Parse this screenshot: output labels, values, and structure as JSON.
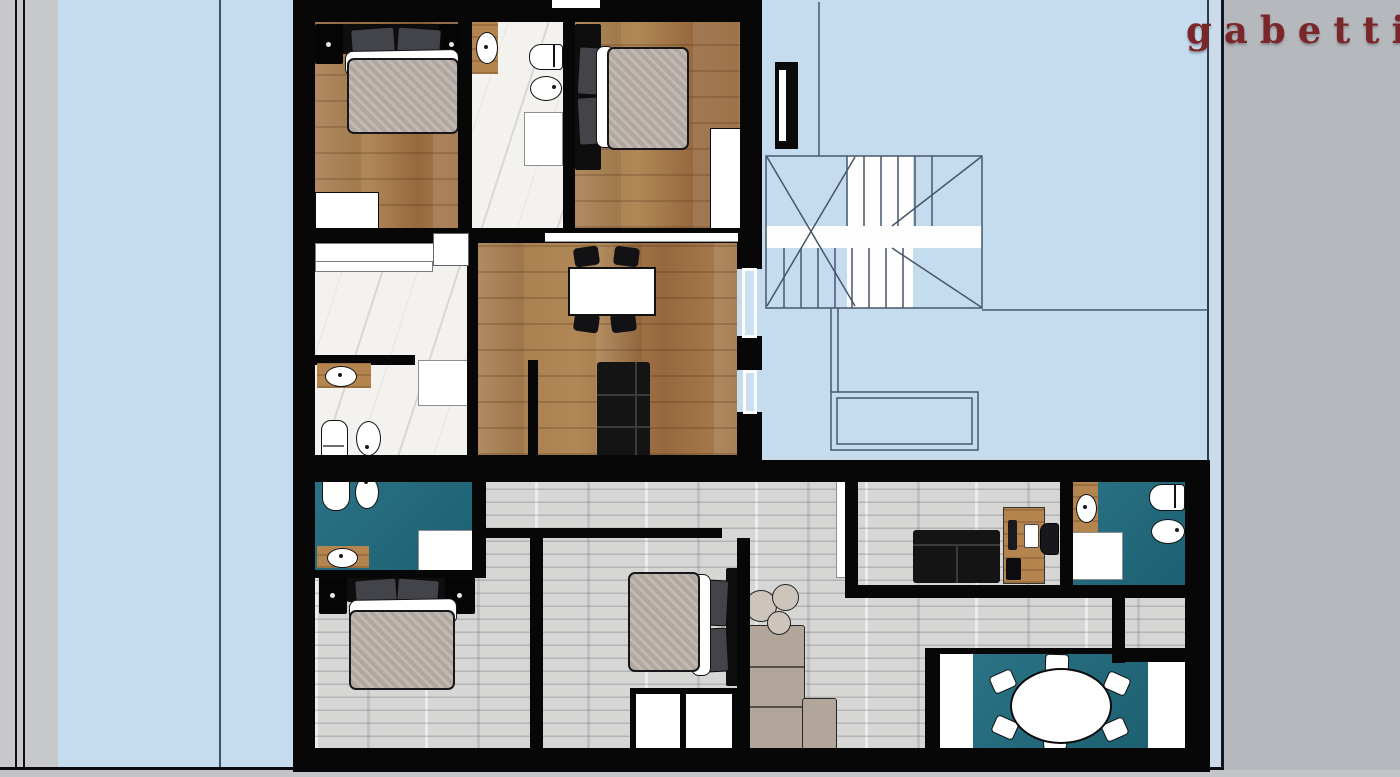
{
  "brand": {
    "name": "gabetti",
    "color": "#7b2628"
  },
  "palette": {
    "sky": "#c4dcee",
    "strip": "#ccdbe9",
    "paper": "#b5b8bc",
    "band": "#c6c8ca",
    "wall": "#070708",
    "wood": "#a57a4c",
    "graywood": "#d6d6d4",
    "marble": "#f4f2ee",
    "teal": "#1f6b7e",
    "counter": "#b5854f",
    "mattress": "#b9b1a8",
    "pillow": "#43444a",
    "beige": "#b2a69b",
    "pouf": "#cdc5bc",
    "blue_line": "#46566a",
    "brand": "#7b2628"
  },
  "floor_plan": {
    "stairwell": {
      "elements": [
        "staircase",
        "half-landing",
        "lower-landing",
        "entrance-door"
      ]
    },
    "upper_apartment": {
      "floor_finishes": {
        "bedrooms": "oak parquet",
        "bathrooms": "white marble",
        "living": "oak parquet"
      },
      "rooms": [
        {
          "name": "bedroom-1",
          "furniture": [
            "double bed",
            "two nightstands",
            "wardrobe"
          ]
        },
        {
          "name": "bathroom-1",
          "furniture": [
            "washbasin counter",
            "toilet",
            "bidet",
            "door"
          ]
        },
        {
          "name": "bedroom-2",
          "furniture": [
            "double bed",
            "wardrobe"
          ]
        },
        {
          "name": "living-dining",
          "furniture": [
            "dining table",
            "four chairs",
            "sofa",
            "window sill"
          ]
        },
        {
          "name": "dressing-room",
          "furniture": [
            "counter units"
          ]
        },
        {
          "name": "bathroom-2",
          "furniture": [
            "washbasin counter",
            "toilet",
            "bidet",
            "door"
          ]
        }
      ]
    },
    "lower_apartment": {
      "floor_finishes": {
        "rooms": "light gray parquet",
        "bathrooms": "teal tile"
      },
      "rooms": [
        {
          "name": "bathroom-3",
          "furniture": [
            "toilet",
            "bidet",
            "washbasin counter",
            "door"
          ]
        },
        {
          "name": "bedroom-3",
          "furniture": [
            "double bed",
            "two nightstands"
          ]
        },
        {
          "name": "bedroom-4",
          "furniture": [
            "double bed",
            "wardrobe doors"
          ]
        },
        {
          "name": "study",
          "furniture": [
            "sofa",
            "desk",
            "monitor",
            "office chair",
            "door"
          ]
        },
        {
          "name": "bathroom-4",
          "furniture": [
            "washbasin counter",
            "toilet",
            "bidet",
            "door"
          ]
        },
        {
          "name": "living-corner",
          "furniture": [
            "corner sofa",
            "three poufs"
          ]
        },
        {
          "name": "dining-room",
          "furniture": [
            "oval table",
            "six chairs",
            "teal rug"
          ]
        },
        {
          "name": "storage",
          "furniture": []
        }
      ]
    }
  }
}
